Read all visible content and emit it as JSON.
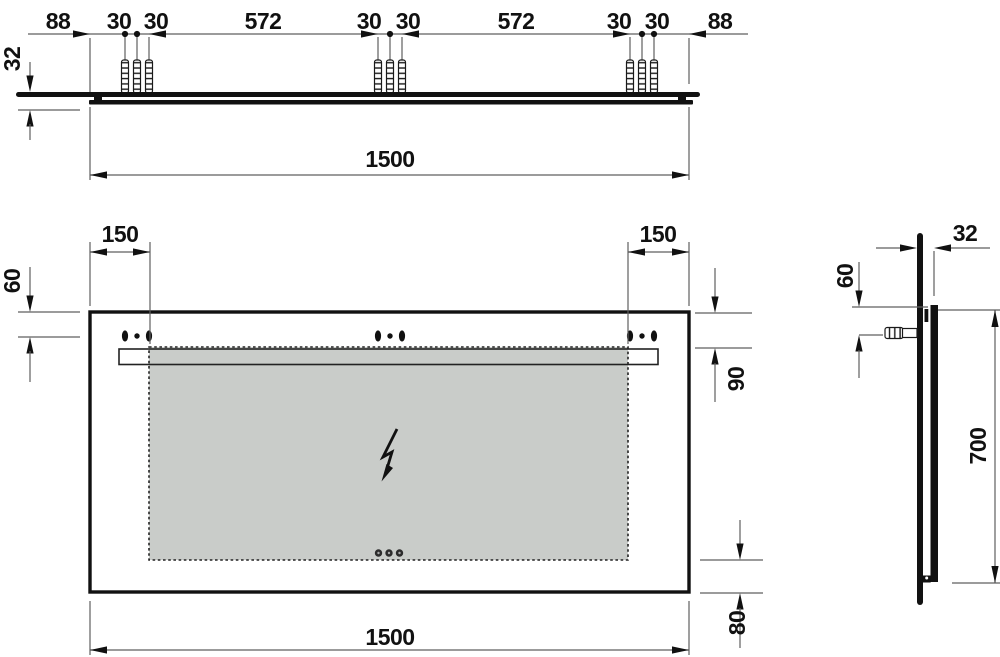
{
  "drawing": {
    "title": "mirror-installation-dimension-drawing",
    "colors": {
      "line": "#111111",
      "thin_line": "#5f5f5f",
      "panel_fill": "#c9ccc9",
      "background": "#ffffff"
    },
    "icons": {
      "power_connection": "lightning-bolt-icon",
      "wall_anchor": "wall-plug-icon",
      "sensor_buttons": "sensor-dots-icon",
      "mounting_slots": "mounting-slot-icon"
    },
    "labels": {
      "tv_left_88": "88",
      "tv_g1_30a": "30",
      "tv_g1_30b": "30",
      "tv_span_572a": "572",
      "tv_g2_30a": "30",
      "tv_g2_30b": "30",
      "tv_span_572b": "572",
      "tv_g3_30a": "30",
      "tv_g3_30b": "30",
      "tv_right_88": "88",
      "tv_depth_32": "32",
      "tv_width_1500": "1500",
      "fv_left_150": "150",
      "fv_right_150": "150",
      "fv_left_60": "60",
      "fv_right_90": "90",
      "fv_bottom_80": "80",
      "fv_width_1500": "1500",
      "sv_depth_32": "32",
      "sv_top_60": "60",
      "sv_height_700": "700"
    }
  }
}
